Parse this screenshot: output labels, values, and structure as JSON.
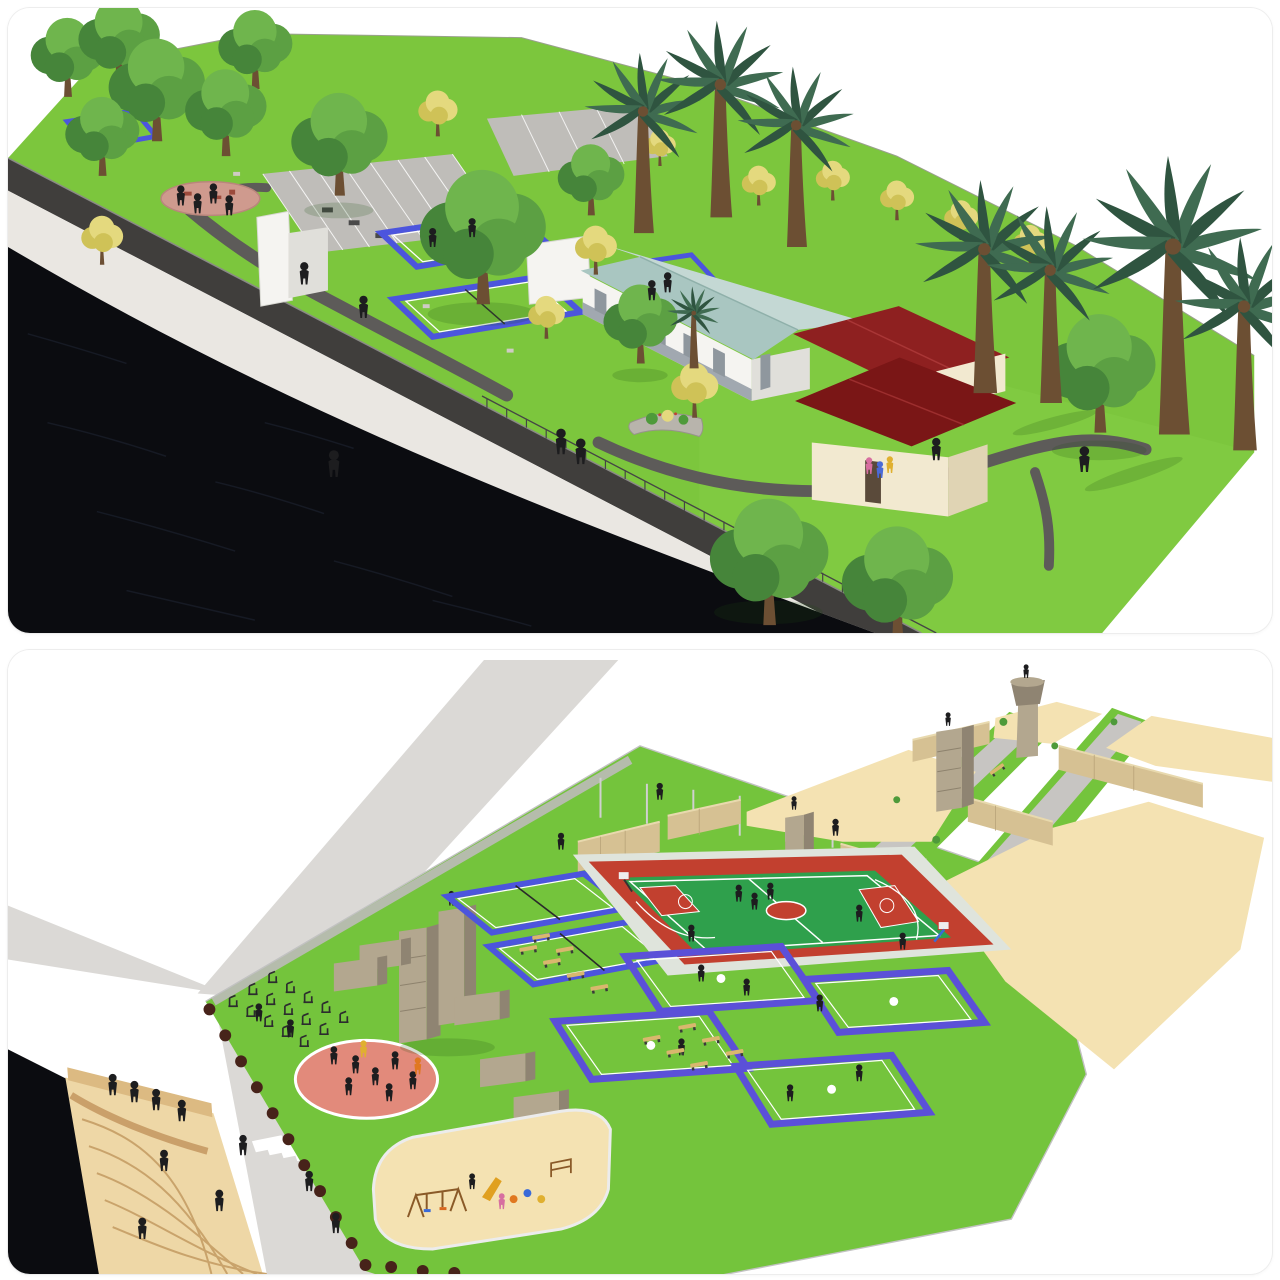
{
  "page": {
    "type": "image-collage",
    "description": "Two 3D landscape-architecture renderings stacked vertically on a white background with rounded corners",
    "text_content": "none (image contains no visible text)"
  },
  "panels": {
    "top": {
      "name": "riverside-linear-park-render",
      "scene": [
        "dark canal water",
        "white embankment wall",
        "dark promenade walkway with railing",
        "bright lawns",
        "circular pink plaza with playground",
        "parking lots with white stalls",
        "badminton courts with violet-blue borders",
        "white screen walls",
        "community building with pale-teal hip roof and stone wainscot",
        "two cream buildings with dark-red hip roofs",
        "broadleaf trees",
        "yellow flowering trees",
        "fan palm trees",
        "curved gray footpaths",
        "pedestrian silhouettes"
      ]
    },
    "bottom": {
      "name": "sports-complex-aerial-render",
      "scene": [
        "light gray access roads",
        "zebra crosswalk",
        "curved riverside amphitheater steps",
        "canal water corner",
        "rows of outdoor gym equipment",
        "pink fitness circle",
        "concrete climbing towers",
        "low obstacle walls",
        "badminton courts blue-trimmed",
        "basketball court red and green",
        "four volleyball courts purple-trimmed",
        "tan benches",
        "sand playground with swings",
        "dark hedge rows",
        "chain-link perimeter fence",
        "sand training lots",
        "tan boundary walls",
        "watch towers",
        "pedestrian silhouettes"
      ]
    }
  },
  "palette": {
    "water": "#0b0c10",
    "ripple": "#35405a",
    "wallFace": "#eae7e2",
    "wallCap": "#403e3c",
    "land": "#7cc63d",
    "landB": "#74c43c",
    "pathDark": "#5d5b59",
    "roadGray": "#dbd9d6",
    "roadMid": "#c7c5c2",
    "parking": "#bfbdb9",
    "plaza": "#cf9a8e",
    "courtGreen": "#2f9e4c",
    "courtBlue": "#4c55dd",
    "courtPurple": "#5b50d8",
    "bballRed": "#c2402f",
    "bballGreen": "#2fa04c",
    "roofTeal": "#a9c6c1",
    "roofTealLight": "#c4d8d4",
    "roofRed": "#8e2020",
    "roofRedDark": "#7a1616",
    "bldgWhite": "#f5f4f1",
    "bldgShade": "#e0dfda",
    "cream": "#f2e9d0",
    "creamShade": "#e0d4b4",
    "stoneBand": "#98a0a8",
    "concrete": "#b3a78f",
    "concreteDark": "#8f8472",
    "sand": "#f4e2b2",
    "sandWall": "#d6c193",
    "sandWallShade": "#b8a378",
    "steps": "#eed7a6",
    "stepsLine": "#c9a36b",
    "hedge": "#47231a",
    "shrub": "#4e9a3a",
    "tree1": "#5ca043",
    "tree2": "#46853a",
    "tree3": "#6fb54d",
    "treeYellow": "#e4d97e",
    "treeYellow2": "#cfc257",
    "palmGreen": "#3f6b51",
    "palmDark": "#2f5440",
    "trunk": "#6c4f33",
    "person": "#1d1d1f",
    "bench": "#d9b76e",
    "pinkCircle": "#e28a7b",
    "fence": "#c2c2c2",
    "gym": "#2c2c2e"
  }
}
